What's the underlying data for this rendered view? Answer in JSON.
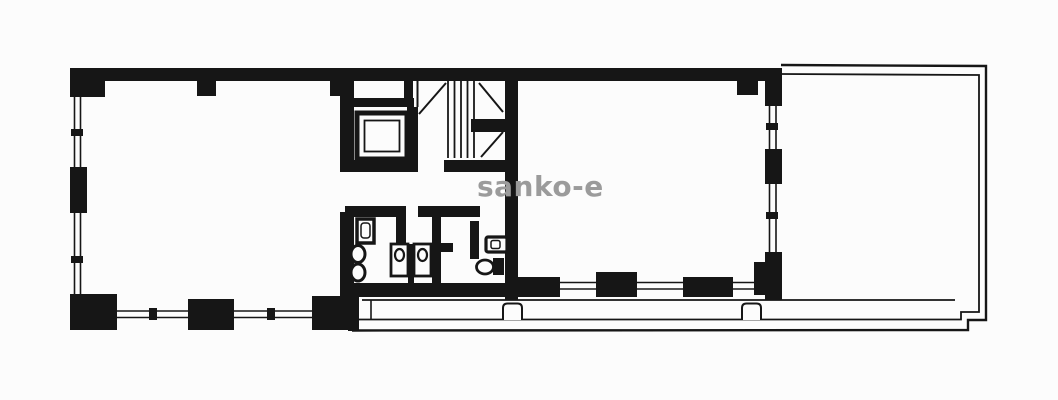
{
  "canvas": {
    "width": 1058,
    "height": 400,
    "background": "#fcfcfc",
    "line_color": "#161616"
  },
  "watermark": {
    "text": "sanko-e",
    "color": "#9b9b9b"
  },
  "diagram": {
    "type": "architectural-floor-plan",
    "elements": [
      {
        "name": "left-room",
        "kind": "room with window walls and corner columns"
      },
      {
        "name": "pipe-shaft",
        "kind": "small service shaft"
      },
      {
        "name": "elevator",
        "kind": "elevator shaft with inner cab outline"
      },
      {
        "name": "staircase",
        "kind": "dog-leg stair with treads and break lines"
      },
      {
        "name": "mens-restroom",
        "kind": "restroom with sink, urinals, two stalls"
      },
      {
        "name": "womens-restroom",
        "kind": "restroom with sink and toilet"
      },
      {
        "name": "right-room",
        "kind": "room with window walls and columns"
      },
      {
        "name": "roof-terrace",
        "kind": "open terrace drawn with thin double outline"
      },
      {
        "name": "south-balcony",
        "kind": "long balcony strip along bottom edge"
      }
    ]
  }
}
